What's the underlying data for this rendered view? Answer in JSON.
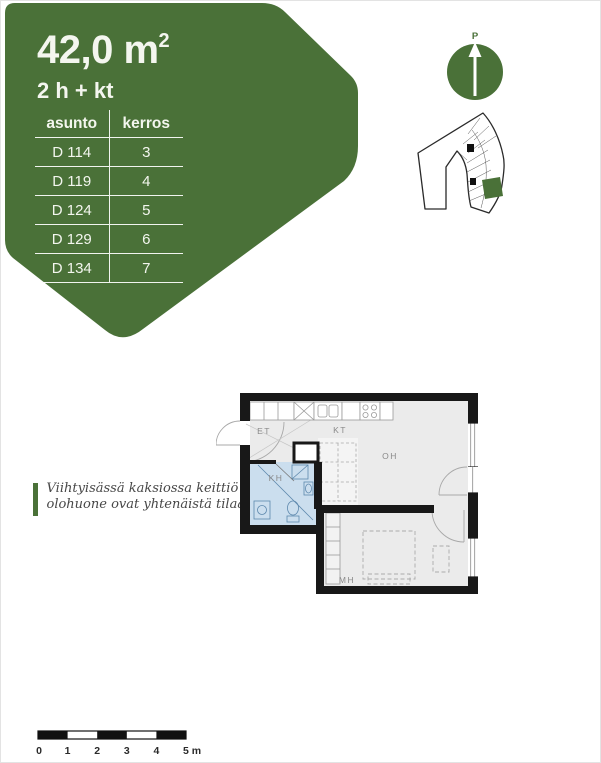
{
  "header": {
    "accent_color": "#4a7138",
    "area_value": "42,0 m",
    "area_superscript": "2",
    "apartment_type": "2 h + kt",
    "table": {
      "col_apartment": "asunto",
      "col_floor": "kerros",
      "rows": [
        {
          "apartment": "D 114",
          "floor": "3"
        },
        {
          "apartment": "D 119",
          "floor": "4"
        },
        {
          "apartment": "D 124",
          "floor": "5"
        },
        {
          "apartment": "D 129",
          "floor": "6"
        },
        {
          "apartment": "D 134",
          "floor": "7"
        }
      ]
    }
  },
  "compass": {
    "north_label": "P"
  },
  "site_plan": {
    "highlight_color": "#4a7138"
  },
  "note": {
    "line1": "Viihtyisässä kaksiossa keittiö ja",
    "line2": "olohuone ovat yhtenäistä tilaa"
  },
  "floor_plan": {
    "bath_color": "#cbdeee",
    "labels": {
      "entry": "ET",
      "kitchen": "KT",
      "living": "OH",
      "bath": "KH",
      "bedroom": "MH"
    }
  },
  "scale_bar": {
    "labels": [
      "0",
      "1",
      "2",
      "3",
      "4",
      "5 m"
    ]
  }
}
